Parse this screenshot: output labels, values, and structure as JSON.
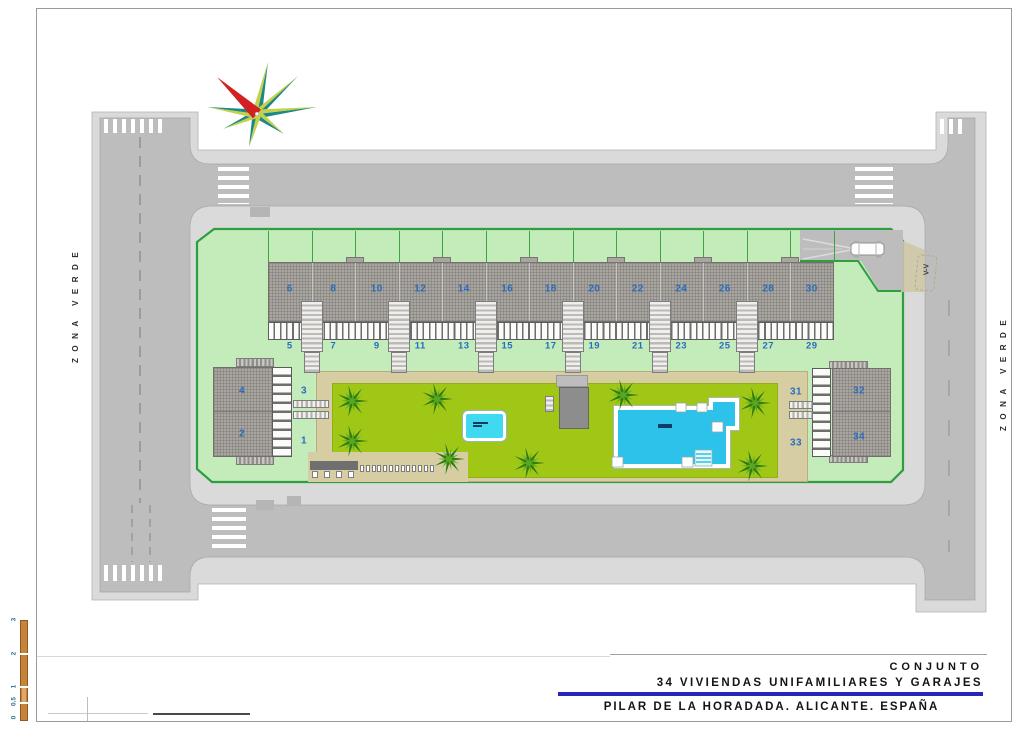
{
  "drawing": {
    "type": "architectural site plan",
    "north_arrow": "compass-rose"
  },
  "title_block": {
    "line1": "CONJUNTO",
    "line2": "34 VIVIENDAS UNIFAMILIARES Y GARAJES",
    "line3": "PILAR DE LA HORADADA. ALICANTE. ESPAÑA",
    "accent_line_color": "#2626b8"
  },
  "labels": {
    "zona_verde_left": "ZONA VERDE",
    "zona_verde_right": "ZONA VERDE",
    "entrance_mark": "V-V"
  },
  "scale_bar": {
    "ticks": [
      "3",
      "2",
      "1",
      "0.5",
      "0"
    ],
    "bar_color": "#c8833a"
  },
  "houses": {
    "top_row_upper": [
      "6",
      "8",
      "10",
      "12",
      "14",
      "16",
      "18",
      "20",
      "22",
      "24",
      "26",
      "28",
      "30"
    ],
    "top_row_lower": [
      "5",
      "7",
      "9",
      "11",
      "13",
      "15",
      "17",
      "19",
      "21",
      "23",
      "25",
      "27",
      "29"
    ],
    "left_block": {
      "top": "4",
      "bottom": "2",
      "top_right": "3",
      "bottom_right": "1"
    },
    "right_block": {
      "top": "32",
      "bottom": "34",
      "top_left": "31",
      "bottom_left": "33"
    }
  },
  "colors": {
    "roadway": "#bcbdbc",
    "sidewalk": "#d9dad9",
    "parcel_green": "#c3ecba",
    "parcel_border": "#2f9e3f",
    "lawn": "#a0c616",
    "path_tan": "#d6cda2",
    "pool_water": "#2cc2ea",
    "house_number_blue": "#2a6cbe",
    "compass_red": "#d32020",
    "compass_teal": "#1d8888"
  }
}
